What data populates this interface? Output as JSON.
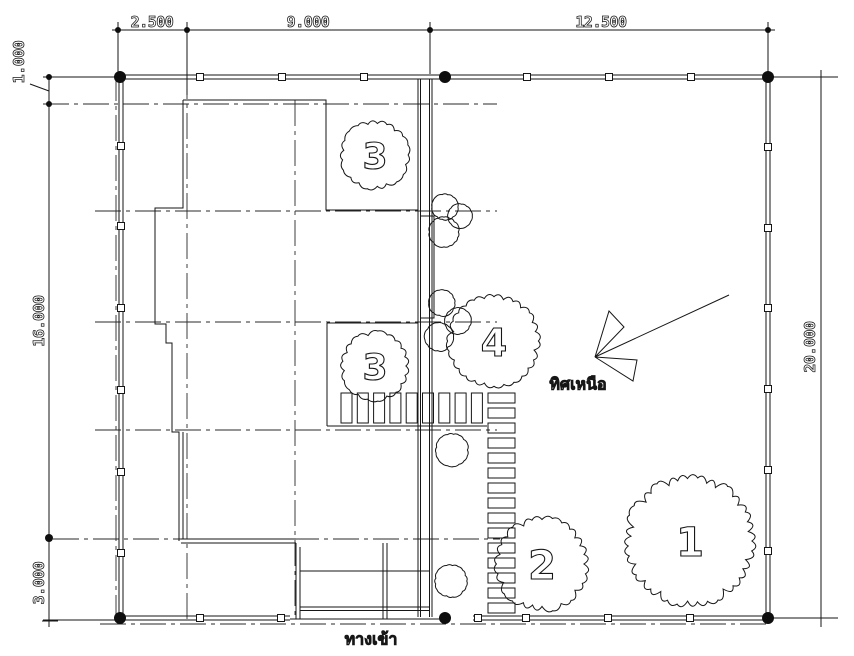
{
  "drawing": {
    "background": "#ffffff",
    "line_color": "#161616",
    "dim_labels": {
      "top": [
        {
          "text": "2.500",
          "x": 152,
          "y": 22
        },
        {
          "text": "9.000",
          "x": 308,
          "y": 22
        },
        {
          "text": "12.500",
          "x": 601,
          "y": 22
        }
      ],
      "left": [
        {
          "text": "1.000",
          "x": 19,
          "y": 62
        },
        {
          "text": "16.000",
          "x": 39,
          "y": 321
        },
        {
          "text": "3.000",
          "x": 39,
          "y": 583
        }
      ],
      "right": [
        {
          "text": "20.000",
          "x": 810,
          "y": 347
        }
      ]
    },
    "annotations": {
      "north_label": "ทิศเหนือ",
      "entrance_label": "ทางเข้า"
    },
    "grid": {
      "h": [
        [
          104,
          43,
          497
        ],
        [
          211,
          95,
          497
        ],
        [
          322,
          95,
          497
        ],
        [
          430,
          95,
          497
        ],
        [
          539,
          53,
          500
        ],
        [
          624,
          100,
          770
        ]
      ],
      "v": [
        [
          187,
          33,
          622
        ],
        [
          295,
          100,
          619
        ],
        [
          116,
          75,
          619
        ]
      ]
    },
    "fences": [
      {
        "name": "top",
        "o": "h",
        "c": 77,
        "a1": 118,
        "a2": 770,
        "posts": [
          200,
          282,
          364,
          527,
          609,
          691
        ]
      },
      {
        "name": "left",
        "o": "v",
        "c": 121,
        "a1": 75,
        "a2": 620,
        "posts": [
          146,
          226,
          308,
          390,
          472,
          553
        ]
      },
      {
        "name": "right",
        "o": "v",
        "c": 768,
        "a1": 75,
        "a2": 620,
        "posts": [
          147,
          228,
          308,
          389,
          470,
          551
        ]
      },
      {
        "name": "bottom-left",
        "o": "h",
        "c": 618,
        "a1": 118,
        "a2": 290,
        "posts": [
          200,
          281
        ]
      },
      {
        "name": "bottom-right",
        "o": "h",
        "c": 618,
        "a1": 473,
        "a2": 770,
        "posts": [
          478,
          526,
          608,
          690
        ]
      }
    ],
    "markers": [
      [
        120,
        77,
        6
      ],
      [
        445,
        77,
        6
      ],
      [
        768,
        77,
        6
      ],
      [
        120,
        618,
        6
      ],
      [
        445,
        618,
        6
      ],
      [
        768,
        618,
        6
      ],
      [
        49,
        538,
        4
      ]
    ],
    "small_dots": [
      [
        118,
        30
      ],
      [
        187,
        30
      ],
      [
        430,
        30
      ],
      [
        768,
        30
      ],
      [
        49,
        77
      ],
      [
        49,
        104
      ]
    ],
    "hatch_bars": {
      "x0": 341,
      "pitch": 16.3,
      "count": 9,
      "w": 11,
      "y": 393,
      "h": 30
    },
    "stones": {
      "x": 488,
      "w": 27,
      "y0": 393,
      "pitch": 15,
      "count": 15,
      "h": 10
    },
    "trees": [
      {
        "label": "1",
        "cx": 690,
        "cy": 541,
        "r": 62,
        "fs": 40
      },
      {
        "label": "2",
        "cx": 542,
        "cy": 564,
        "r": 45,
        "fs": 40
      },
      {
        "label": "3",
        "cx": 375,
        "cy": 155,
        "r": 33,
        "fs": 36
      },
      {
        "label": "3",
        "cx": 375,
        "cy": 366,
        "r": 33,
        "fs": 36
      },
      {
        "label": "4",
        "cx": 494,
        "cy": 341,
        "r": 44,
        "fs": 38
      }
    ],
    "bushes": [
      {
        "cx": 445,
        "cy": 207,
        "r": 13
      },
      {
        "cx": 460,
        "cy": 216,
        "r": 12
      },
      {
        "cx": 444,
        "cy": 232,
        "r": 15
      },
      {
        "cx": 442,
        "cy": 303,
        "r": 13
      },
      {
        "cx": 458,
        "cy": 321,
        "r": 13
      },
      {
        "cx": 439,
        "cy": 337,
        "r": 14
      },
      {
        "cx": 452,
        "cy": 450,
        "r": 16
      },
      {
        "cx": 451,
        "cy": 581,
        "r": 16
      }
    ]
  }
}
